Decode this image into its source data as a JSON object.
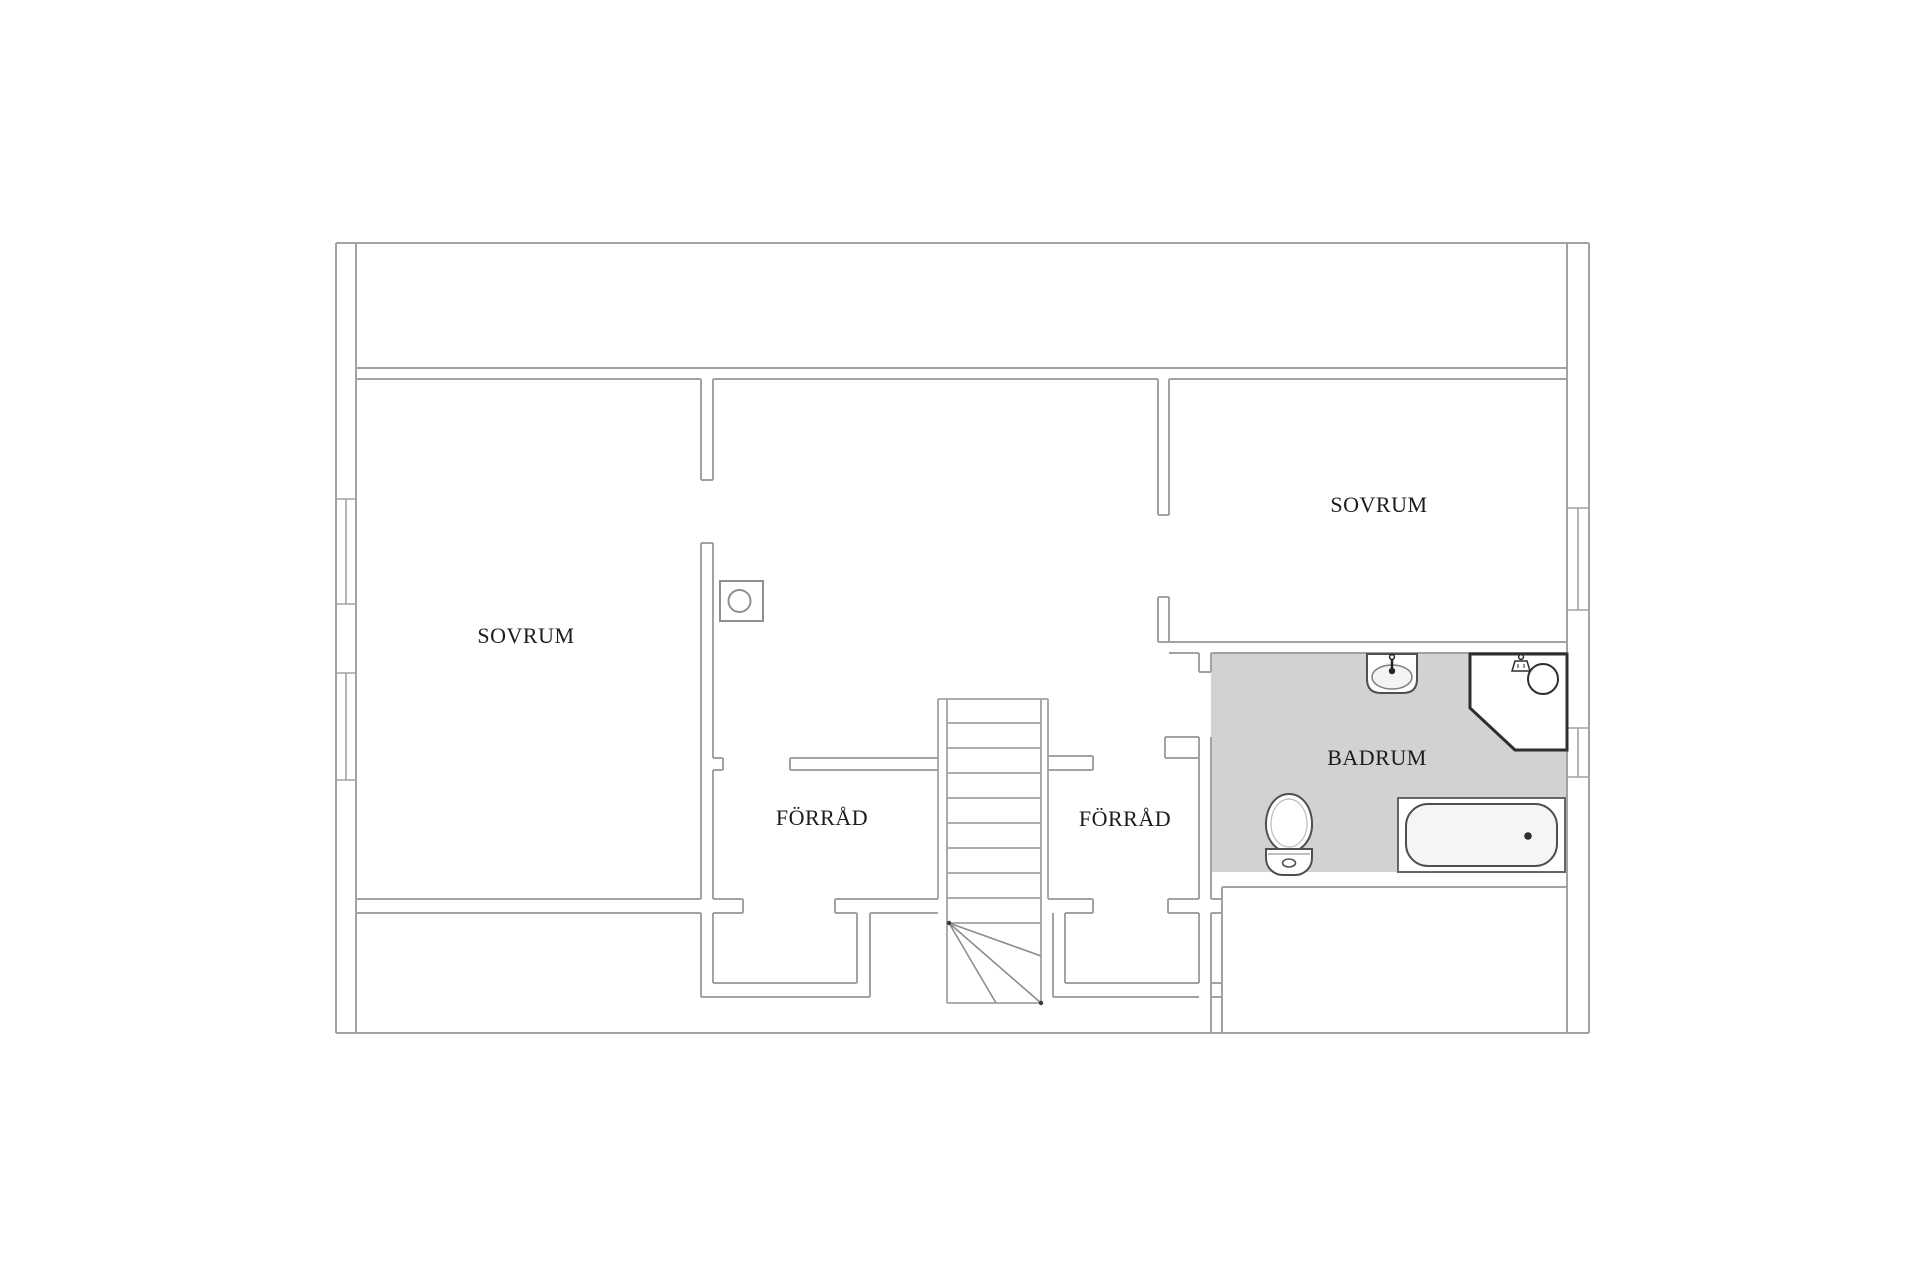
{
  "plan_type": "floor-plan",
  "rooms": {
    "sovrum_left": "SOVRUM",
    "sovrum_right": "SOVRUM",
    "forrad_left": "FÖRRÅD",
    "forrad_right": "FÖRRÅD",
    "badrum": "BADRUM"
  },
  "fixtures": [
    "staircase",
    "chimney",
    "washbasin",
    "corner-shower",
    "toilet",
    "bathtub"
  ],
  "colors": {
    "wall_line": "#a2a2a2",
    "bathroom_floor": "#d2d2d2",
    "fixture_dark": "#2e2e2e",
    "fixture_mid": "#4f4f4f",
    "text": "#1c1c1c"
  }
}
